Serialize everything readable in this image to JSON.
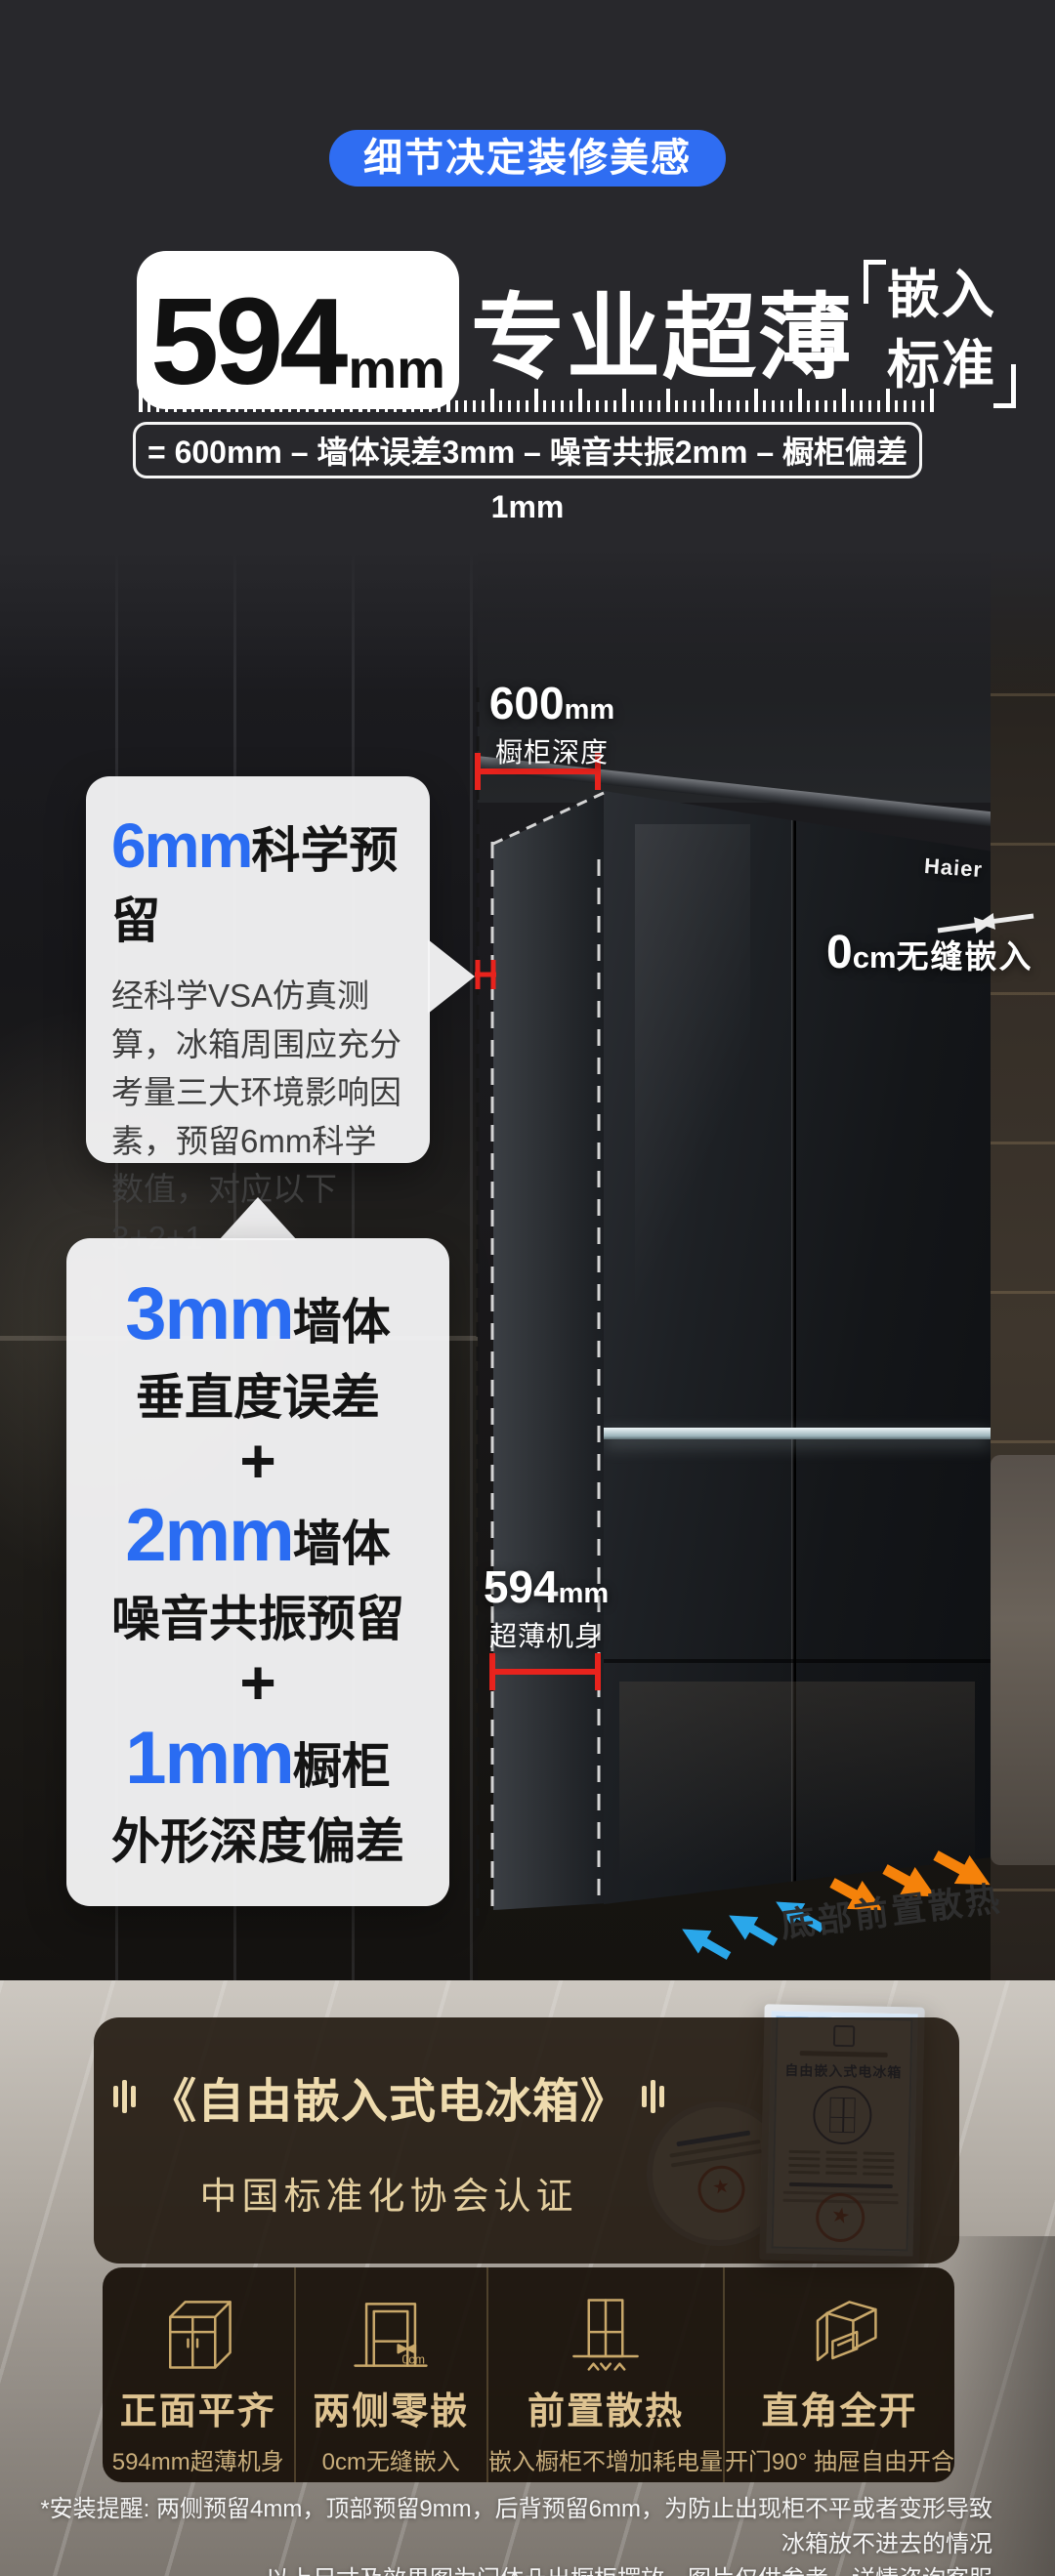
{
  "header": {
    "pill": "细节决定装修美感",
    "title_number": "594",
    "title_unit": "mm",
    "title_main": "专业超薄",
    "bracket_line1": "嵌入",
    "bracket_line2": "标准",
    "formula": "= 600mm – 墙体误差3mm – 噪音共振2mm – 橱柜偏差1mm"
  },
  "diagram": {
    "brand": "Haier",
    "cabinet_depth_number": "600",
    "cabinet_depth_unit": "mm",
    "cabinet_depth_label": "橱柜深度",
    "body_depth_number": "594",
    "body_depth_unit": "mm",
    "body_depth_label": "超薄机身",
    "zero_gap_number": "0",
    "zero_gap_unit": "cm",
    "zero_gap_label": "无缝嵌入",
    "heat_label": "底部前置散热",
    "callout_6mm_number": "6mm",
    "callout_6mm_title": "科学预留",
    "callout_6mm_body": "经科学VSA仿真测算，冰箱周围应充分考量三大环境影响因素，预留6mm科学数值，对应以下3+2+1",
    "breakdown_plus": "+",
    "breakdown": [
      {
        "number": "3mm",
        "suffix": "墙体",
        "detail": "垂直度误差"
      },
      {
        "number": "2mm",
        "suffix": "墙体",
        "detail": "噪音共振预留"
      },
      {
        "number": "1mm",
        "suffix": "橱柜",
        "detail": "外形深度偏差"
      }
    ]
  },
  "certificate": {
    "title": "《自由嵌入式电冰箱》",
    "subtitle": "中国标准化协会认证",
    "doc_title": "自由嵌入式电冰箱"
  },
  "features": [
    {
      "title": "正面平齐",
      "subtitle": "594mm超薄机身"
    },
    {
      "title": "两侧零嵌",
      "subtitle": "0cm无缝嵌入",
      "icon_text": "0cm"
    },
    {
      "title": "前置散热",
      "subtitle": "嵌入橱柜不增加耗电量"
    },
    {
      "title": "直角全开",
      "subtitle": "开门90°  抽屉自由开合"
    }
  ],
  "footnote": {
    "line1": "*安装提醒: 两侧预留4mm，顶部预留9mm，后背预留6mm，为防止出现柜不平或者变形导致冰箱放不进去的情况",
    "line2": "以上尺寸及效果图为门体凸出橱柜摆放，图片仅供参考，详情咨询客服"
  },
  "colors": {
    "accent_blue": "#2f6df2",
    "number_blue": "#2a6cf2",
    "measure_red": "#e8231d",
    "arrow_blue": "#2aa7ea",
    "arrow_orange": "#f5820a",
    "gold": "#dec391",
    "background": "#28282c"
  }
}
